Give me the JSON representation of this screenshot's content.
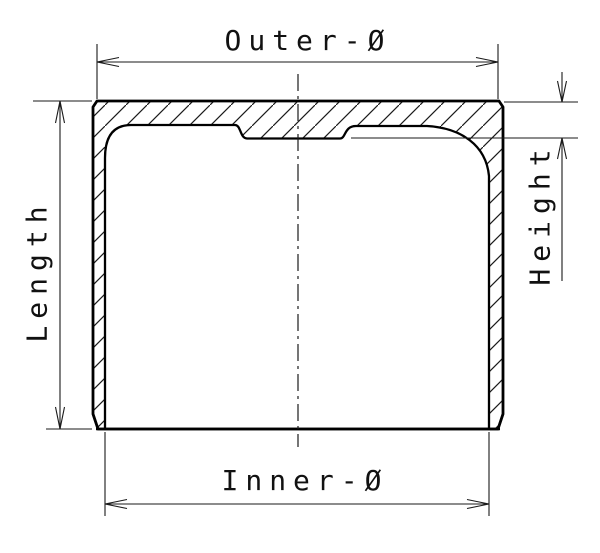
{
  "drawing": {
    "kind": "technical cross-section, cam follower / bucket tappet",
    "labels": {
      "outer_diameter": "Outer-Ø",
      "length": "Length",
      "height": "Height",
      "inner_diameter": "Inner-Ø"
    }
  },
  "colors": {
    "line": "#000000",
    "thin_line": "#1a1a1a",
    "background": "#ffffff"
  }
}
